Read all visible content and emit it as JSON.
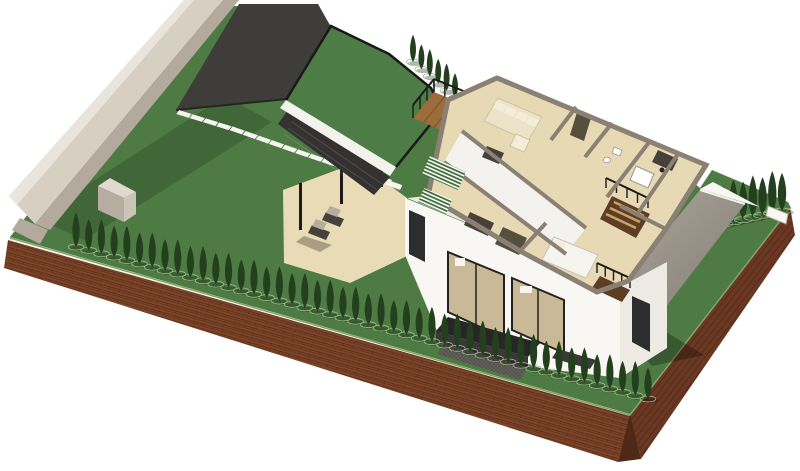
{
  "scene": {
    "name": "axonometric-house-site-render",
    "canvas": {
      "width": 800,
      "height": 471
    },
    "colors": {
      "bg": "#ffffff",
      "lawn": "#4e7a43",
      "grassEdge": "#85a468",
      "shadow": "rgba(22,32,14,0.22)",
      "shadowStrong": "rgba(0,0,0,0.28)",
      "soil": "#7c4428",
      "soilDark": "#693722",
      "soilLine": "#5a2d1a",
      "soilTip": "#4f2817",
      "wall": "#d7cfc2",
      "wallLight": "#eae5dc",
      "wallDark": "#b3a99c",
      "boxFront": "#b7aca0",
      "boxSide": "#cdc4b8",
      "boxTop": "#e0d9cf",
      "courtyard": "#3e3d3a",
      "courtEdge": "#26251f",
      "pathDash": "#f6f5f1",
      "roofGreen": "#4e7c46",
      "fascia": "#f4f2ed",
      "trim": "#191917",
      "louverWall": "#343230",
      "louverLine": "rgba(255,255,255,0.14)",
      "deckWood": "#9c6d3a",
      "deckLine": "#7b5226",
      "rail": "#1c1b19",
      "patio": "#e8dbb6",
      "white": "#f8f7f3",
      "whiteShade": "#eceae3",
      "cutWall": "#8a8074",
      "floor": "#e6d9b4",
      "wedge": "#f4f2ee",
      "glass": "#c9b996",
      "windowDark": "#2b2d2e",
      "frame": "#23221f",
      "grayRoofA": "#aba59c",
      "grayRoofB": "#867f76",
      "underWall": "#c6c1b7",
      "cream": "#ece3c8",
      "creamLight": "#f3edda",
      "creamStroke": "#cdc3a6",
      "furnDark": "#46403a",
      "furnOlive": "#574f3e",
      "bedWhite": "#f6f4ee",
      "bedStroke": "#c9c4b8",
      "stairWood": "#c7a365",
      "brownFloor": "#5d3d24",
      "hedge": "#243f1e",
      "hedgeLight": "#9cbd8c",
      "canopy": "#262624",
      "canopyFace": "#3a3836",
      "mesh": "#6e6c66",
      "meshDark": "#55534e",
      "mat": "#3c3a36",
      "fixture": "#ffffff",
      "fixtureStroke": "#9a958c",
      "stripeGreen": "#3f6d3b"
    },
    "sw_hedge": {
      "count": 46,
      "x1": 76,
      "y1": 247,
      "x2": 648,
      "y2": 399,
      "tree_h": 33,
      "tree_w": 6
    },
    "ne_hedge": {
      "count": 8,
      "x1": 714,
      "y1": 226,
      "x2": 782,
      "y2": 211,
      "tree_h": 40,
      "tree_w": 7
    },
    "roof_trees": {
      "count": 6,
      "x1": 413,
      "y1": 62,
      "x2": 455,
      "y2": 98,
      "tree_h": 26,
      "tree_w": 5
    },
    "path_dashes": {
      "count": 17,
      "points": [
        [
          184,
          114
        ],
        [
          236,
          130
        ],
        [
          296,
          151
        ],
        [
          352,
          170
        ],
        [
          398,
          186
        ]
      ],
      "len": 13,
      "w": 4.5
    },
    "deck_rail": {
      "posts": 6,
      "height": 13,
      "x1": 434,
      "y1": 92,
      "x2": 488,
      "y2": 114
    },
    "deck_rail_l": {
      "posts": 4,
      "height": 13,
      "x1": 434,
      "y1": 92,
      "x2": 413,
      "y2": 118
    },
    "stair_rail": {
      "posts": 5,
      "height": 10,
      "x1": 606,
      "y1": 188,
      "x2": 648,
      "y2": 208
    },
    "balcony_rail": {
      "posts": 5,
      "height": 10,
      "x1": 597,
      "y1": 273,
      "x2": 630,
      "y2": 288
    }
  }
}
